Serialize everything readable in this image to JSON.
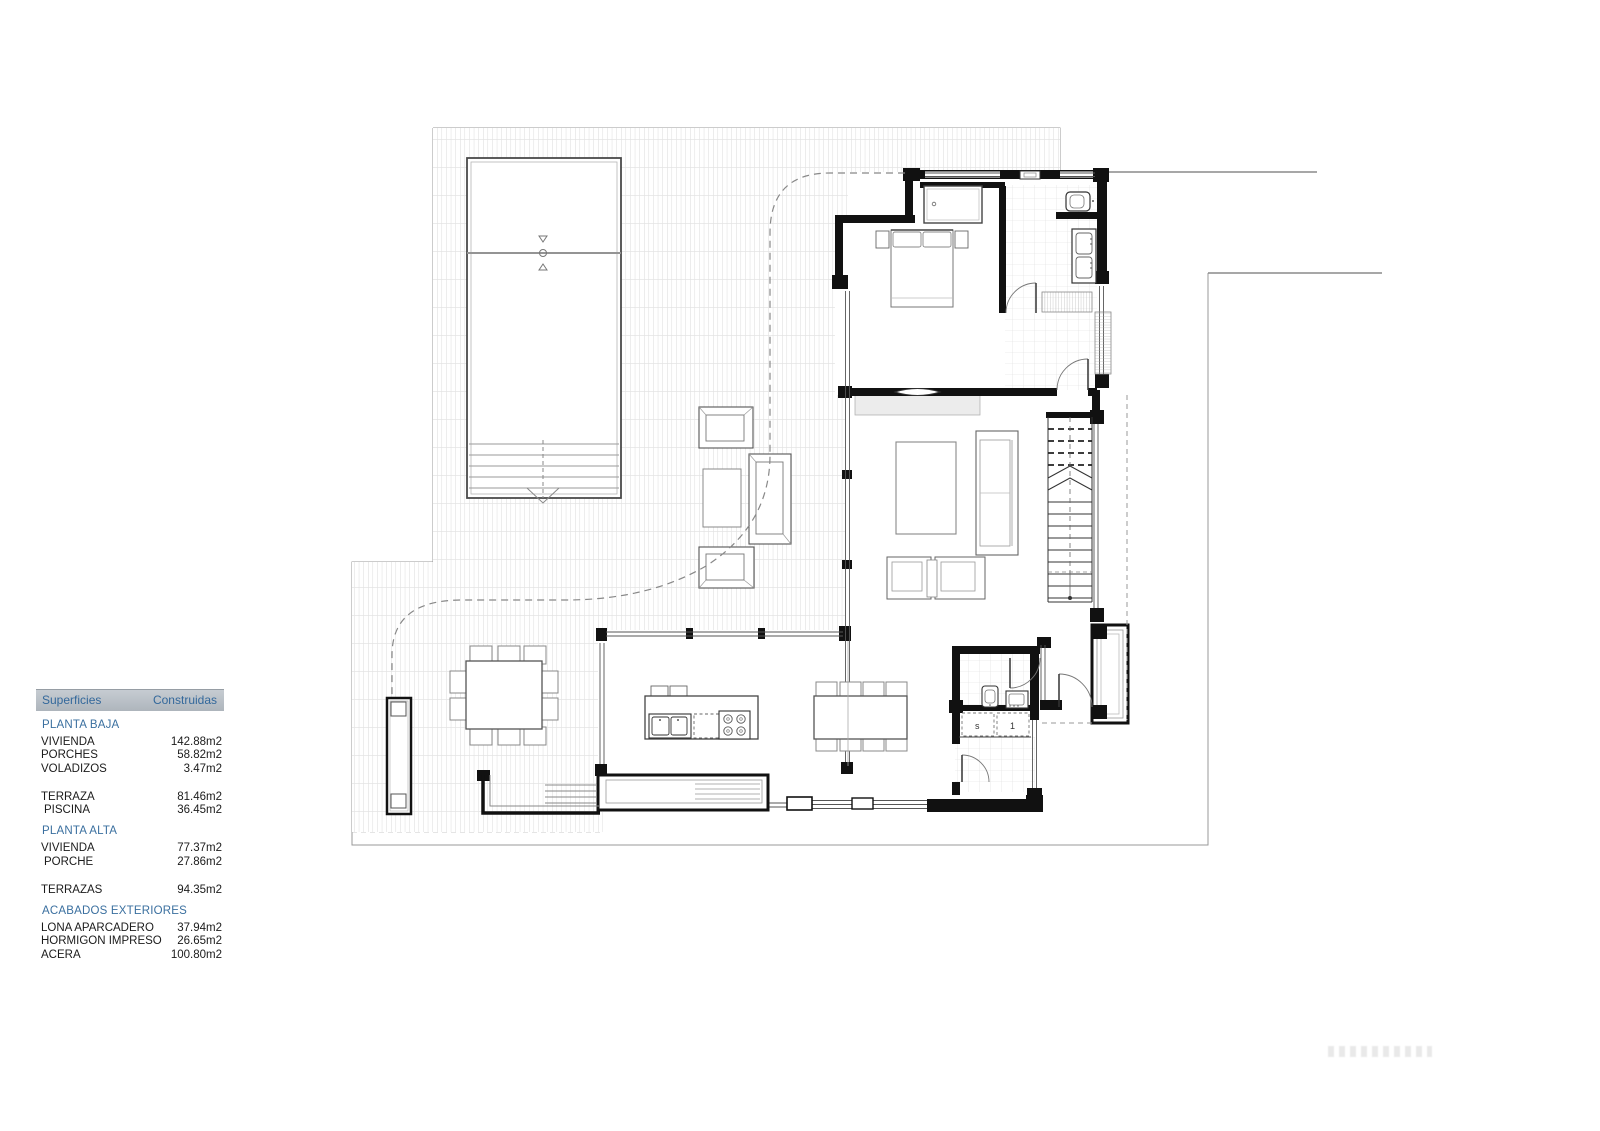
{
  "legend": {
    "header": {
      "col1": "Superficies",
      "col2": "Construidas"
    },
    "sections": [
      {
        "title": "PLANTA BAJA",
        "rows": [
          {
            "label": "VIVIENDA",
            "value": "142.88m2"
          },
          {
            "label": "PORCHES",
            "value": "58.82m2"
          },
          {
            "label": "VOLADIZOS",
            "value": "3.47m2"
          },
          {
            "label": "TERRAZA",
            "value": "81.46m2"
          },
          {
            "label": "PISCINA",
            "value": "36.45m2"
          }
        ]
      },
      {
        "title": "PLANTA ALTA",
        "rows": [
          {
            "label": "VIVIENDA",
            "value": "77.37m2"
          },
          {
            "label": "PORCHE",
            "value": "27.86m2"
          },
          {
            "label": "TERRAZAS",
            "value": "94.35m2"
          }
        ]
      },
      {
        "title": "ACABADOS EXTERIORES",
        "rows": [
          {
            "label": "LONA APARCADERO",
            "value": "37.94m2"
          },
          {
            "label": "HORMIGON IMPRESO",
            "value": "26.65m2"
          },
          {
            "label": "ACERA",
            "value": "100.80m2"
          }
        ]
      }
    ],
    "colors": {
      "header_bg": "#b9c0c6",
      "header_text": "#33689b",
      "section_text": "#3a6f9f",
      "row_text": "#1b1b1b"
    }
  },
  "plan": {
    "labels": {
      "appliance_left": "s",
      "appliance_right": "1"
    },
    "colors": {
      "wall": "#111111",
      "hatch": "#cccccc",
      "tile": "#dddddd",
      "boundary": "#999999"
    }
  }
}
